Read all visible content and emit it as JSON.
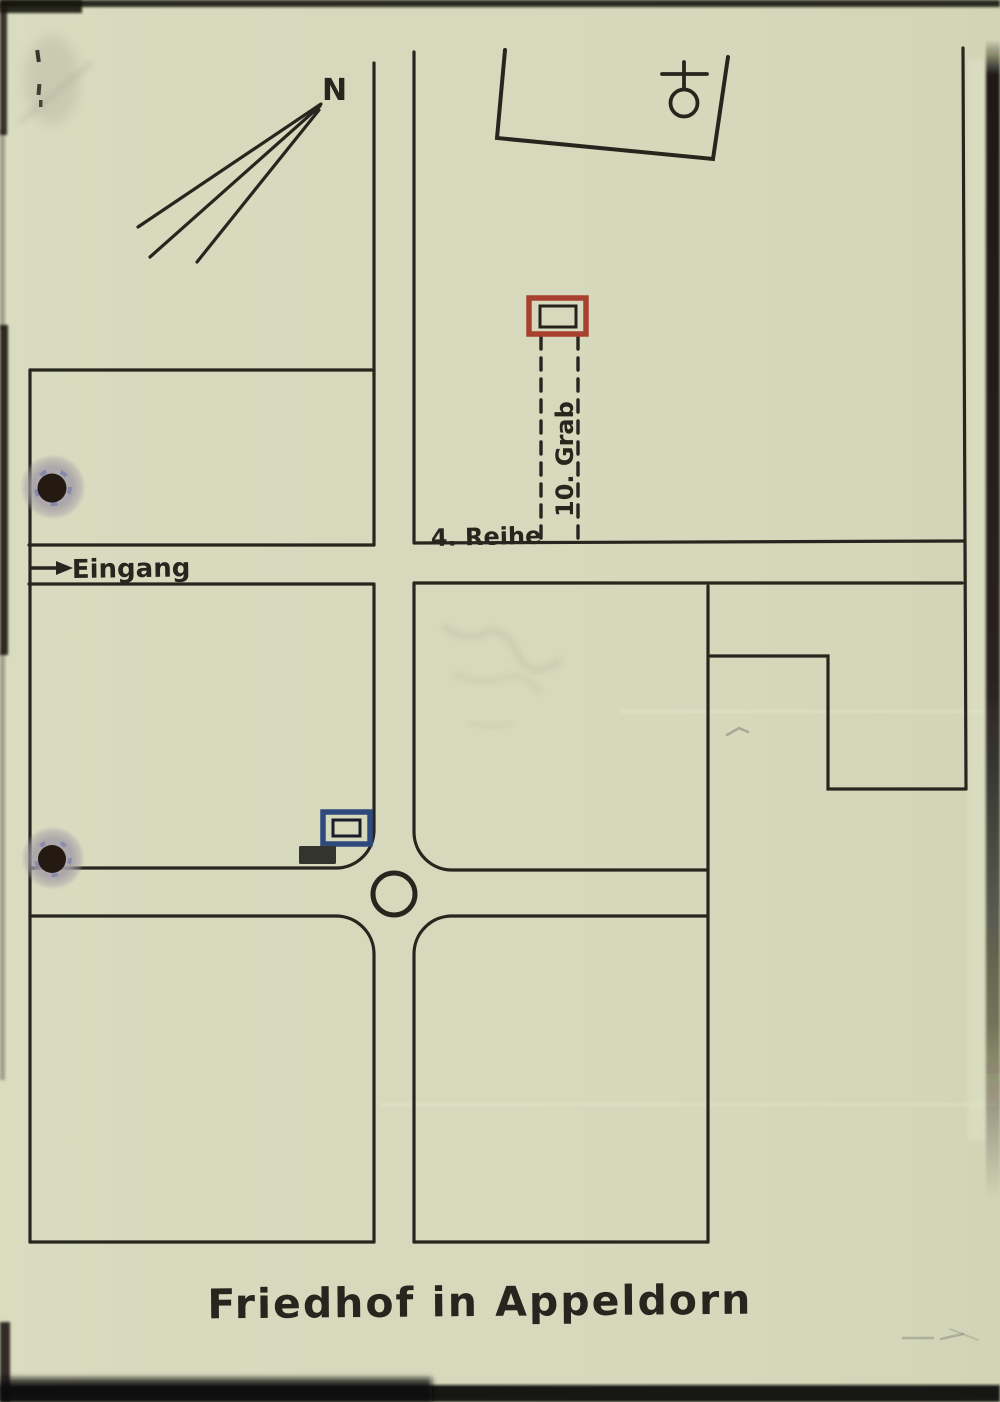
{
  "document": {
    "kind": "scanned hand-drawn cemetery map",
    "title": "Friedhof in Appeldorn"
  },
  "map": {
    "north_label": "N",
    "entrance_label": "Eingang",
    "row_label": "4. Reihe",
    "grave_label": "10. Grab"
  },
  "icons": {
    "chapel": "circle-with-cross chapel symbol",
    "north_arrow": "three-line compass arrow pointing north-east",
    "entrance_arrow": "right-pointing arrow",
    "marked_grave": "red outlined grave rectangle",
    "reference_grave": "blue outlined grave rectangle",
    "filled_block": "small solid dark rectangle",
    "hole_punch": "binder hole punch"
  },
  "colors": {
    "paper": "#d7d9bd",
    "ink": "#26261e",
    "grave_red": "#a84030",
    "grave_blue": "#2e4a7d",
    "punch_halo": "#a49ea6",
    "punch_hole": "#241a12",
    "scan_edge": "#14110b"
  }
}
